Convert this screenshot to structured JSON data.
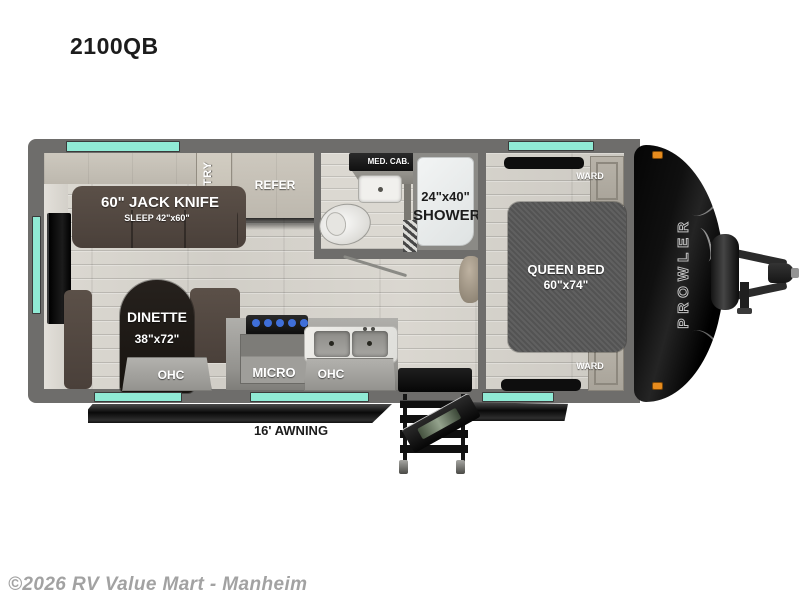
{
  "title": "2100QB",
  "brand_logo": "PROWLER",
  "watermark": "©2026 RV Value Mart - Manheim",
  "labels": {
    "sofa_line1": "60\" JACK KNIFE",
    "sofa_line2": "SLEEP 42\"x60\"",
    "pantry": "PANTRY",
    "refer": "REFER",
    "med_cab": "MED. CAB.",
    "shower_line1": "24\"x40\"",
    "shower_line2": "SHOWER",
    "queen_line1": "QUEEN BED",
    "queen_line2": "60\"x74\"",
    "ward_top": "WARD",
    "ward_bottom": "WARD",
    "dinette_line1": "DINETTE",
    "dinette_line2": "38\"x72\"",
    "ohc_dinette": "OHC",
    "micro": "MICRO",
    "ohc_kitchen": "OHC",
    "awning": "16' AWNING"
  },
  "colors": {
    "window_teal": "#90ead5",
    "wall_gray": "#6e6d6b",
    "front_cap_black": "#0a0a0a",
    "marker_light_orange": "#e78c1e",
    "sofa_brown": "#50463f",
    "bed_gray": "#585858"
  }
}
